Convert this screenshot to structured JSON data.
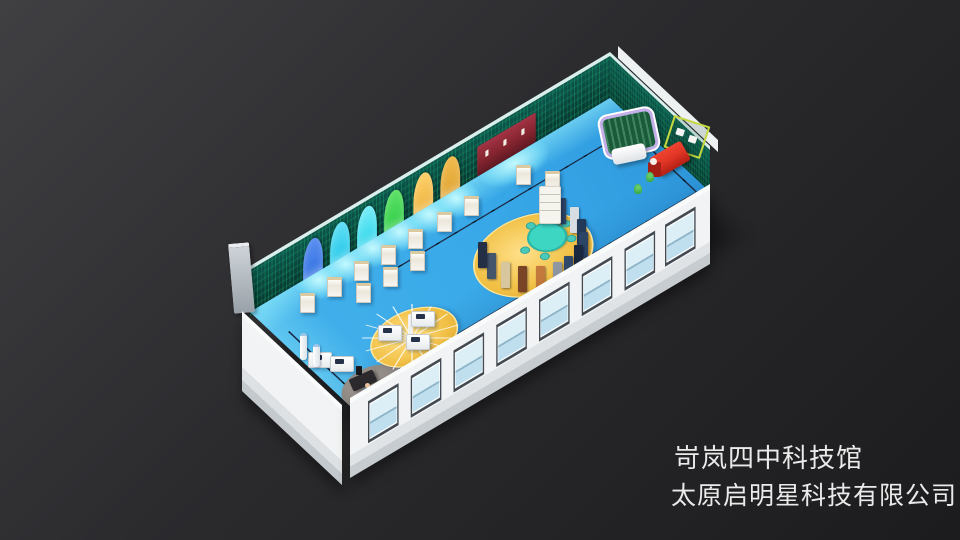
{
  "caption": {
    "line1": "岢岚四中科技馆",
    "line2": "太原启明星科技有限公司"
  },
  "palette": {
    "bg-dark": "#1c1c1e",
    "bg-light": "#404043",
    "floor-blue": "#38a8e8",
    "floor-glow": "#9feef8",
    "wall-teal": "#0d564d",
    "wall-teal-dark": "#07352e",
    "wall-pattern-green": "#23d282",
    "outer-wall": "#f1f3f4",
    "wall-rim": "#d8efec",
    "platform-yellow": "#f1c044",
    "platform-gray": "#8d8782",
    "table-teal": "#3cd6c3",
    "arch-blue": "#2f6fe0",
    "arch-cyan": "#1fc6e8",
    "arch-cyan-2": "#28d4ea",
    "arch-green": "#2ccb44",
    "arch-gold": "#ecb23e",
    "arch-gold-2": "#dfa22f",
    "cabinet-maroon": "#84242f",
    "machine-red": "#e03425",
    "machine-frame": "#c6d93e",
    "board-green": "#1a5c3a",
    "board-frame": "#c3b0e8",
    "track-navy": "#1b2c47",
    "window-frame": "#434a51",
    "window-pane": "#dceef6",
    "text-color": "#eaeaea"
  },
  "exhibits": [
    {
      "name": "wall-arch-booths",
      "count": 6
    },
    {
      "name": "wall-display-cabinet",
      "color": "#84242f"
    },
    {
      "name": "central-oval-platform",
      "color": "#f1c044"
    },
    {
      "name": "curved-display-walls",
      "count": 2
    },
    {
      "name": "round-reading-table",
      "color": "#3cd6c3"
    },
    {
      "name": "display-shelf"
    },
    {
      "name": "umbrella-ray-sculpture"
    },
    {
      "name": "sculpture-platform",
      "color": "#f1c044"
    },
    {
      "name": "student-desks",
      "count": 5
    },
    {
      "name": "exhibit-pedestals",
      "count": 12
    },
    {
      "name": "reception-platform",
      "color": "#8d8782"
    },
    {
      "name": "green-chalkboard",
      "color": "#1a5c3a"
    },
    {
      "name": "red-interactive-machine",
      "color": "#e03425"
    },
    {
      "name": "guide-track",
      "color": "#1b2c47"
    },
    {
      "name": "window-wall",
      "windows": 8
    }
  ]
}
